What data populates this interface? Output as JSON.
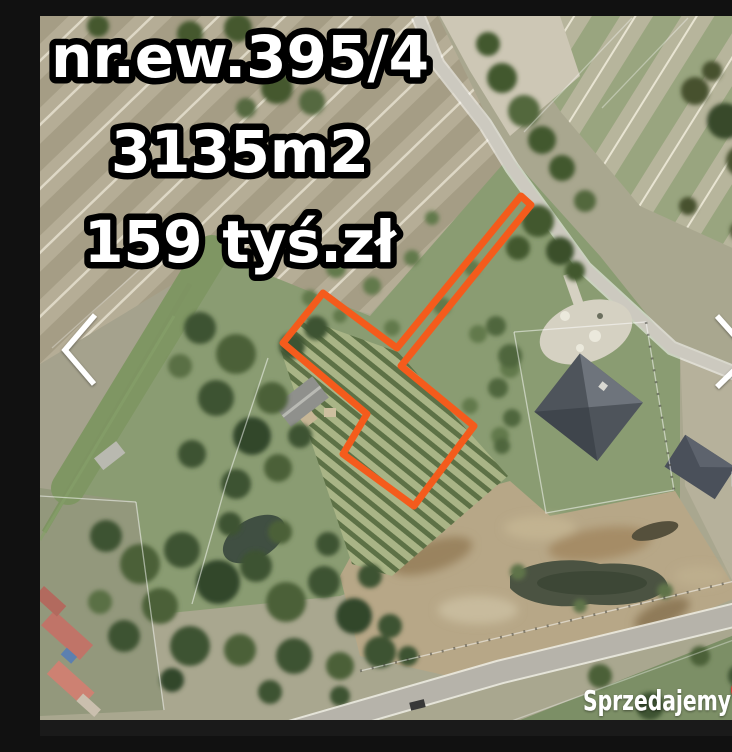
{
  "listing_overlay": {
    "plot_number": "nr.ew.395/4",
    "area": "3135m2",
    "price": "159 tyś.zł"
  },
  "plot_outline": {
    "color": "#f45b1c",
    "points": "283,277 243,327 327,398 303,438 374,490 434,410 361,350 491,189 481,180 357,332"
  },
  "watermark": {
    "brand": "Sprzedajemy",
    "tld": ".pl",
    "badge_color": "#e23530"
  },
  "icons": {
    "prev": "chevron-left",
    "next": "chevron-right"
  },
  "colors": {
    "overlay_text": "#ffffff",
    "overlay_outline": "#000000",
    "chevron": "#ffffff",
    "bottom_bar": "#1a1a1a"
  }
}
